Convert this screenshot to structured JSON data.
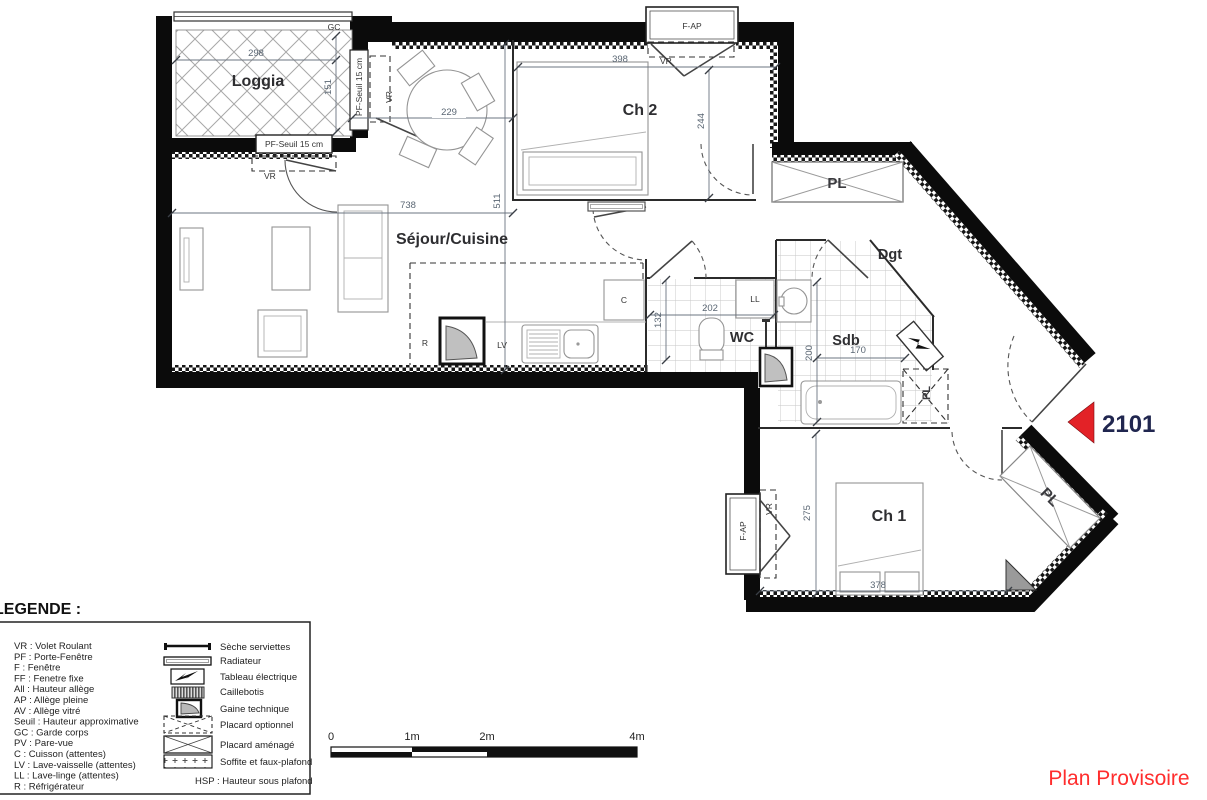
{
  "title_block": {
    "unit": "2101",
    "status": "Plan Provisoire"
  },
  "rooms": {
    "loggia": "Loggia",
    "sejour": "Séjour/Cuisine",
    "ch2": "Ch 2",
    "ch1": "Ch 1",
    "wc": "WC",
    "sdb": "Sdb",
    "dgt": "Dgt"
  },
  "fixtures": {
    "c": "C",
    "lv": "LV",
    "ll": "LL",
    "r": "R"
  },
  "openings": {
    "gc": "GC",
    "vr": "VR",
    "f_ap": "F-AP",
    "pf_seuil": "PF-Seuil 15 cm",
    "pl": "PL"
  },
  "dimensions_cm": {
    "loggia_width": "298",
    "loggia_depth": "151",
    "table": "229",
    "sejour_width": "738",
    "sejour_depth": "511",
    "ch2_width": "398",
    "ch2_depth": "244",
    "wc_width": "202",
    "wc_depth": "132",
    "sdb_depth": "200",
    "sdb_width": "170",
    "ch1_depth": "275",
    "ch1_width": "378"
  },
  "legend": {
    "title": "LEGENDE :",
    "abbreviations": [
      "VR :  Volet Roulant",
      "PF :  Porte-Fenêtre",
      "F :  Fenêtre",
      "FF :  Fenetre fixe",
      "All :  Hauteur allège",
      "AP :  Allège pleine",
      "AV :  Allège vitré",
      "Seuil :  Hauteur approximative",
      "GC :  Garde corps",
      "PV :  Pare-vue",
      "C :  Cuisson (attentes)",
      "LV :  Lave-vaisselle (attentes)",
      "LL :  Lave-linge (attentes)",
      "R :  Réfrigérateur"
    ],
    "symbols": [
      "Sèche serviettes",
      "Radiateur",
      "Tableau électrique",
      "Caillebotis",
      "Gaine technique",
      "Placard optionnel",
      "Placard aménagé",
      "Soffite et faux-plafond"
    ],
    "hsp": "HSP :  Hauteur sous plafond"
  },
  "scale_bar": {
    "ticks": [
      "0",
      "1m",
      "2m",
      "4m"
    ]
  },
  "colors": {
    "arrow_red": "#e32227",
    "watermark_red": "#ff2d2d",
    "unit_navy": "#20264f",
    "dim_text": "#5a6673",
    "wall_black": "#0b0b0b"
  }
}
